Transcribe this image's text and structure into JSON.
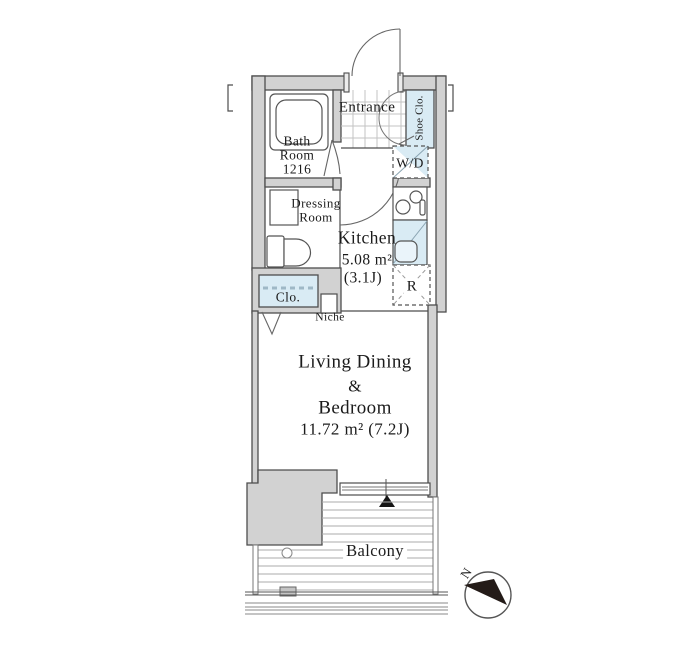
{
  "floorplan": {
    "rooms": {
      "entrance": {
        "label": "Entrance"
      },
      "shoe_closet": {
        "label": "Shoe Clo."
      },
      "bathroom": {
        "line1": "Bath",
        "line2": "Room",
        "line3": "1216"
      },
      "dressing_room": {
        "line1": "Dressing",
        "line2": "Room"
      },
      "washer_dryer": {
        "label": "W/D"
      },
      "kitchen": {
        "name": "Kitchen",
        "area_sqm": "5.08 m²",
        "area_tatami": "(3.1J)"
      },
      "refrigerator": {
        "label": "R"
      },
      "closet": {
        "label": "Clo."
      },
      "niche": {
        "label": "Niche"
      },
      "living": {
        "line1": "Living Dining",
        "line2": "&",
        "line3": "Bedroom",
        "line4": "11.72 m² (7.2J)"
      },
      "balcony": {
        "label": "Balcony"
      }
    },
    "compass": {
      "label": "N"
    },
    "colors": {
      "wall_fill": "#d2d2d2",
      "outline": "#4d4d4d",
      "fixture_fill": "#d9ebf4",
      "text": "#1b1b1b"
    }
  }
}
